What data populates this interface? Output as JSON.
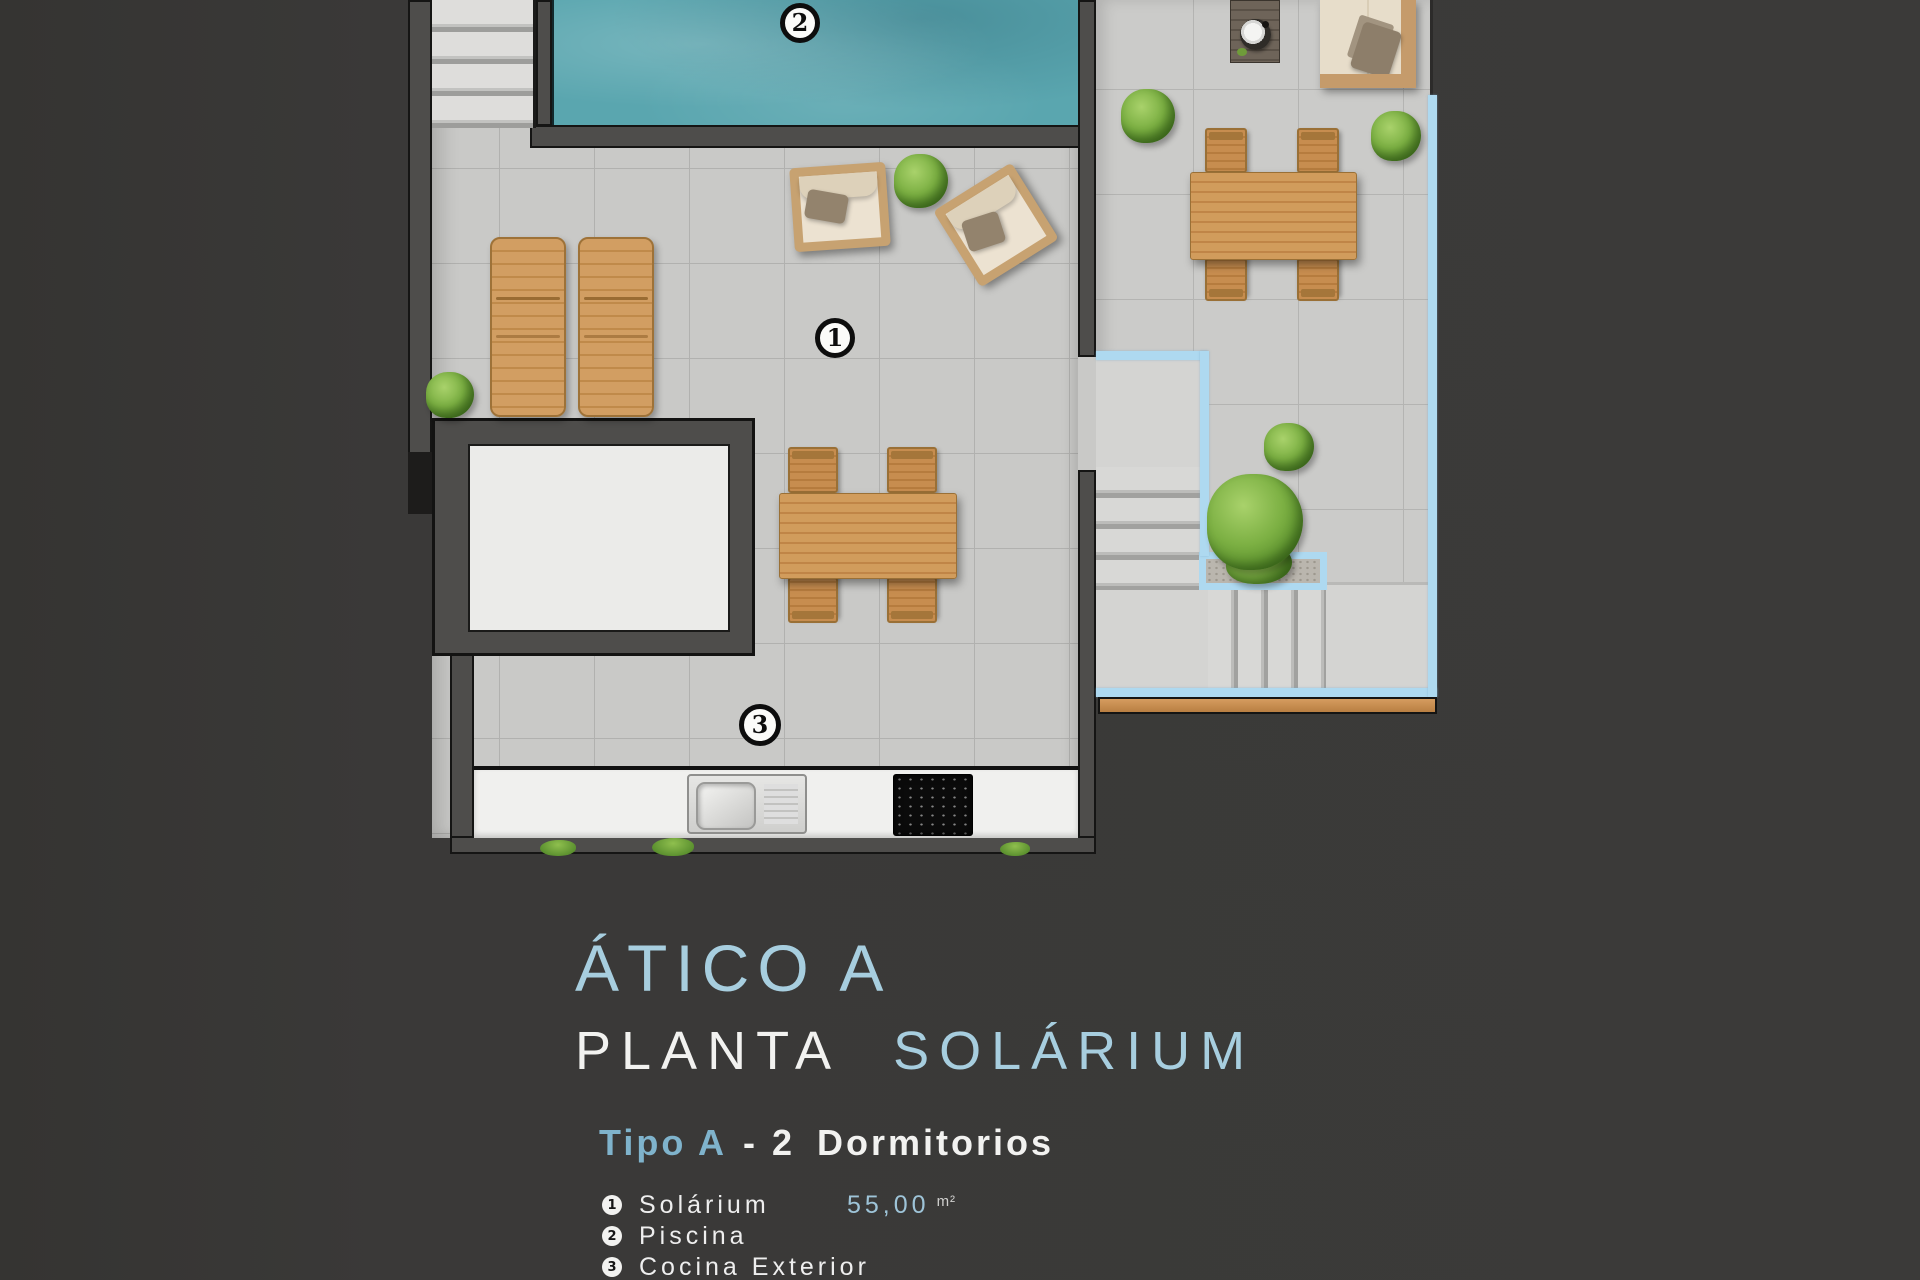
{
  "plan": {
    "markers": [
      {
        "num": "1"
      },
      {
        "num": "2"
      },
      {
        "num": "3"
      }
    ]
  },
  "caption": {
    "title": "ÁTICO A",
    "subtitle_primary": "PLANTA",
    "subtitle_accent": "SOLÁRIUM",
    "type_accent": "Tipo A",
    "type_dash": "-",
    "type_number": "2",
    "type_rest": "Dormitorios",
    "legend": [
      {
        "num": "1",
        "label": "Solárium",
        "area": "55,00",
        "unit": "m²"
      },
      {
        "num": "2",
        "label": "Piscina",
        "area": "",
        "unit": ""
      },
      {
        "num": "3",
        "label": "Cocina Exterior",
        "area": "",
        "unit": ""
      }
    ]
  },
  "colors": {
    "background": "#3a3938",
    "accent_text_blue": "#a7cedf",
    "accent_bold_blue": "#7fb3cc",
    "outline_blue": "#aed9f0",
    "pool_water": "#5aa6af",
    "tile_grey": "#c9c9c7",
    "wall_grey": "#4e4d4b",
    "wood": "#cf9a5c",
    "wood_strip": "#c98d4e"
  }
}
